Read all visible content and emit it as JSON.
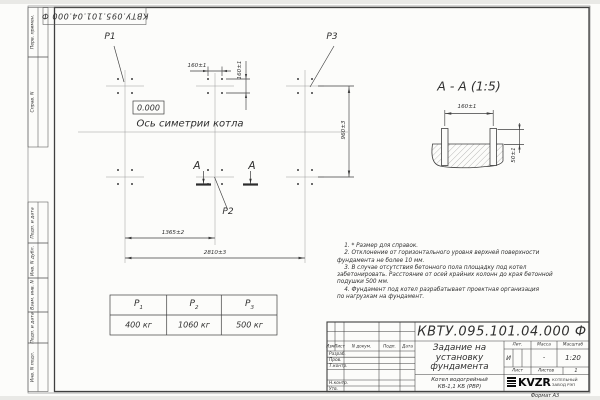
{
  "frame": {
    "top_designation": "КВТУ.095.101.04.000  Ф",
    "left_fields": [
      "Перв. примен.",
      "Справ. N",
      "Подп. и дата",
      "Инв. N дубл.",
      "Взам. инв. N",
      "Подп. и дата",
      "Инв. N подл."
    ],
    "format_label": "Формат А3"
  },
  "plan": {
    "point_labels": {
      "p1": "P1",
      "p2": "P2",
      "p3": "P3"
    },
    "elevation": "0.000",
    "axis_label": "Ось симетрии котла",
    "dims": {
      "h160": "160±1",
      "v160": "160±1",
      "v960": "960±3",
      "h1365": "1365±2",
      "h2810": "2810±3"
    },
    "section_letter": "А"
  },
  "section_view": {
    "title": "А - А (1:5)",
    "dim_160": "160±1",
    "dim_50": "50±1"
  },
  "notes": {
    "lines": [
      "    1. * Размер для справок.",
      "    2. Отклонение от горизонтального уровня верхней поверхности",
      "фундамента не более 10 мм.",
      "    3. В случае отсутствия бетонного пола площадку под котел",
      "забетонировать. Расстояние от осей крайних колонн до края бетонной",
      "подушки 500 мм.",
      "    4. Фундамент под котел разрабатывает проектная организация",
      "по нагрузкам на фундамент."
    ]
  },
  "load_table": {
    "cols": [
      {
        "p": "P",
        "sub": "1",
        "value": "400 кг"
      },
      {
        "p": "P",
        "sub": "2",
        "value": "1060 кг"
      },
      {
        "p": "P",
        "sub": "3",
        "value": "500 кг"
      }
    ]
  },
  "title_block": {
    "designation": "КВТУ.095.101.04.000  Ф",
    "doc_title_lines": [
      "Задание на",
      "установку",
      "фундамента"
    ],
    "product_lines": [
      "Котел водогрейный",
      "КВ-1,1 КБ  (РВР)"
    ],
    "header_cols": [
      "Изм.",
      "Лист",
      "N докум.",
      "Подп.",
      "Дата"
    ],
    "sig_rows": [
      "Разраб.",
      "Пров.",
      "Т.контр.",
      "Н.контр.",
      "Утв."
    ],
    "lit_header": "Лит.",
    "mass_header": "Масса",
    "scale_header": "Масштаб",
    "lit_value": "И",
    "mass_value": "-",
    "scale_value": "1:20",
    "sheet_label": "Лист",
    "sheets_label": "Листов",
    "sheets_value": "1",
    "logo_text": "KVZR",
    "logo_caption_lines": [
      "КОТЕЛЬНЫЙ",
      "ЗАВОД РЭП"
    ],
    "line_color": "#3f3f3f"
  }
}
